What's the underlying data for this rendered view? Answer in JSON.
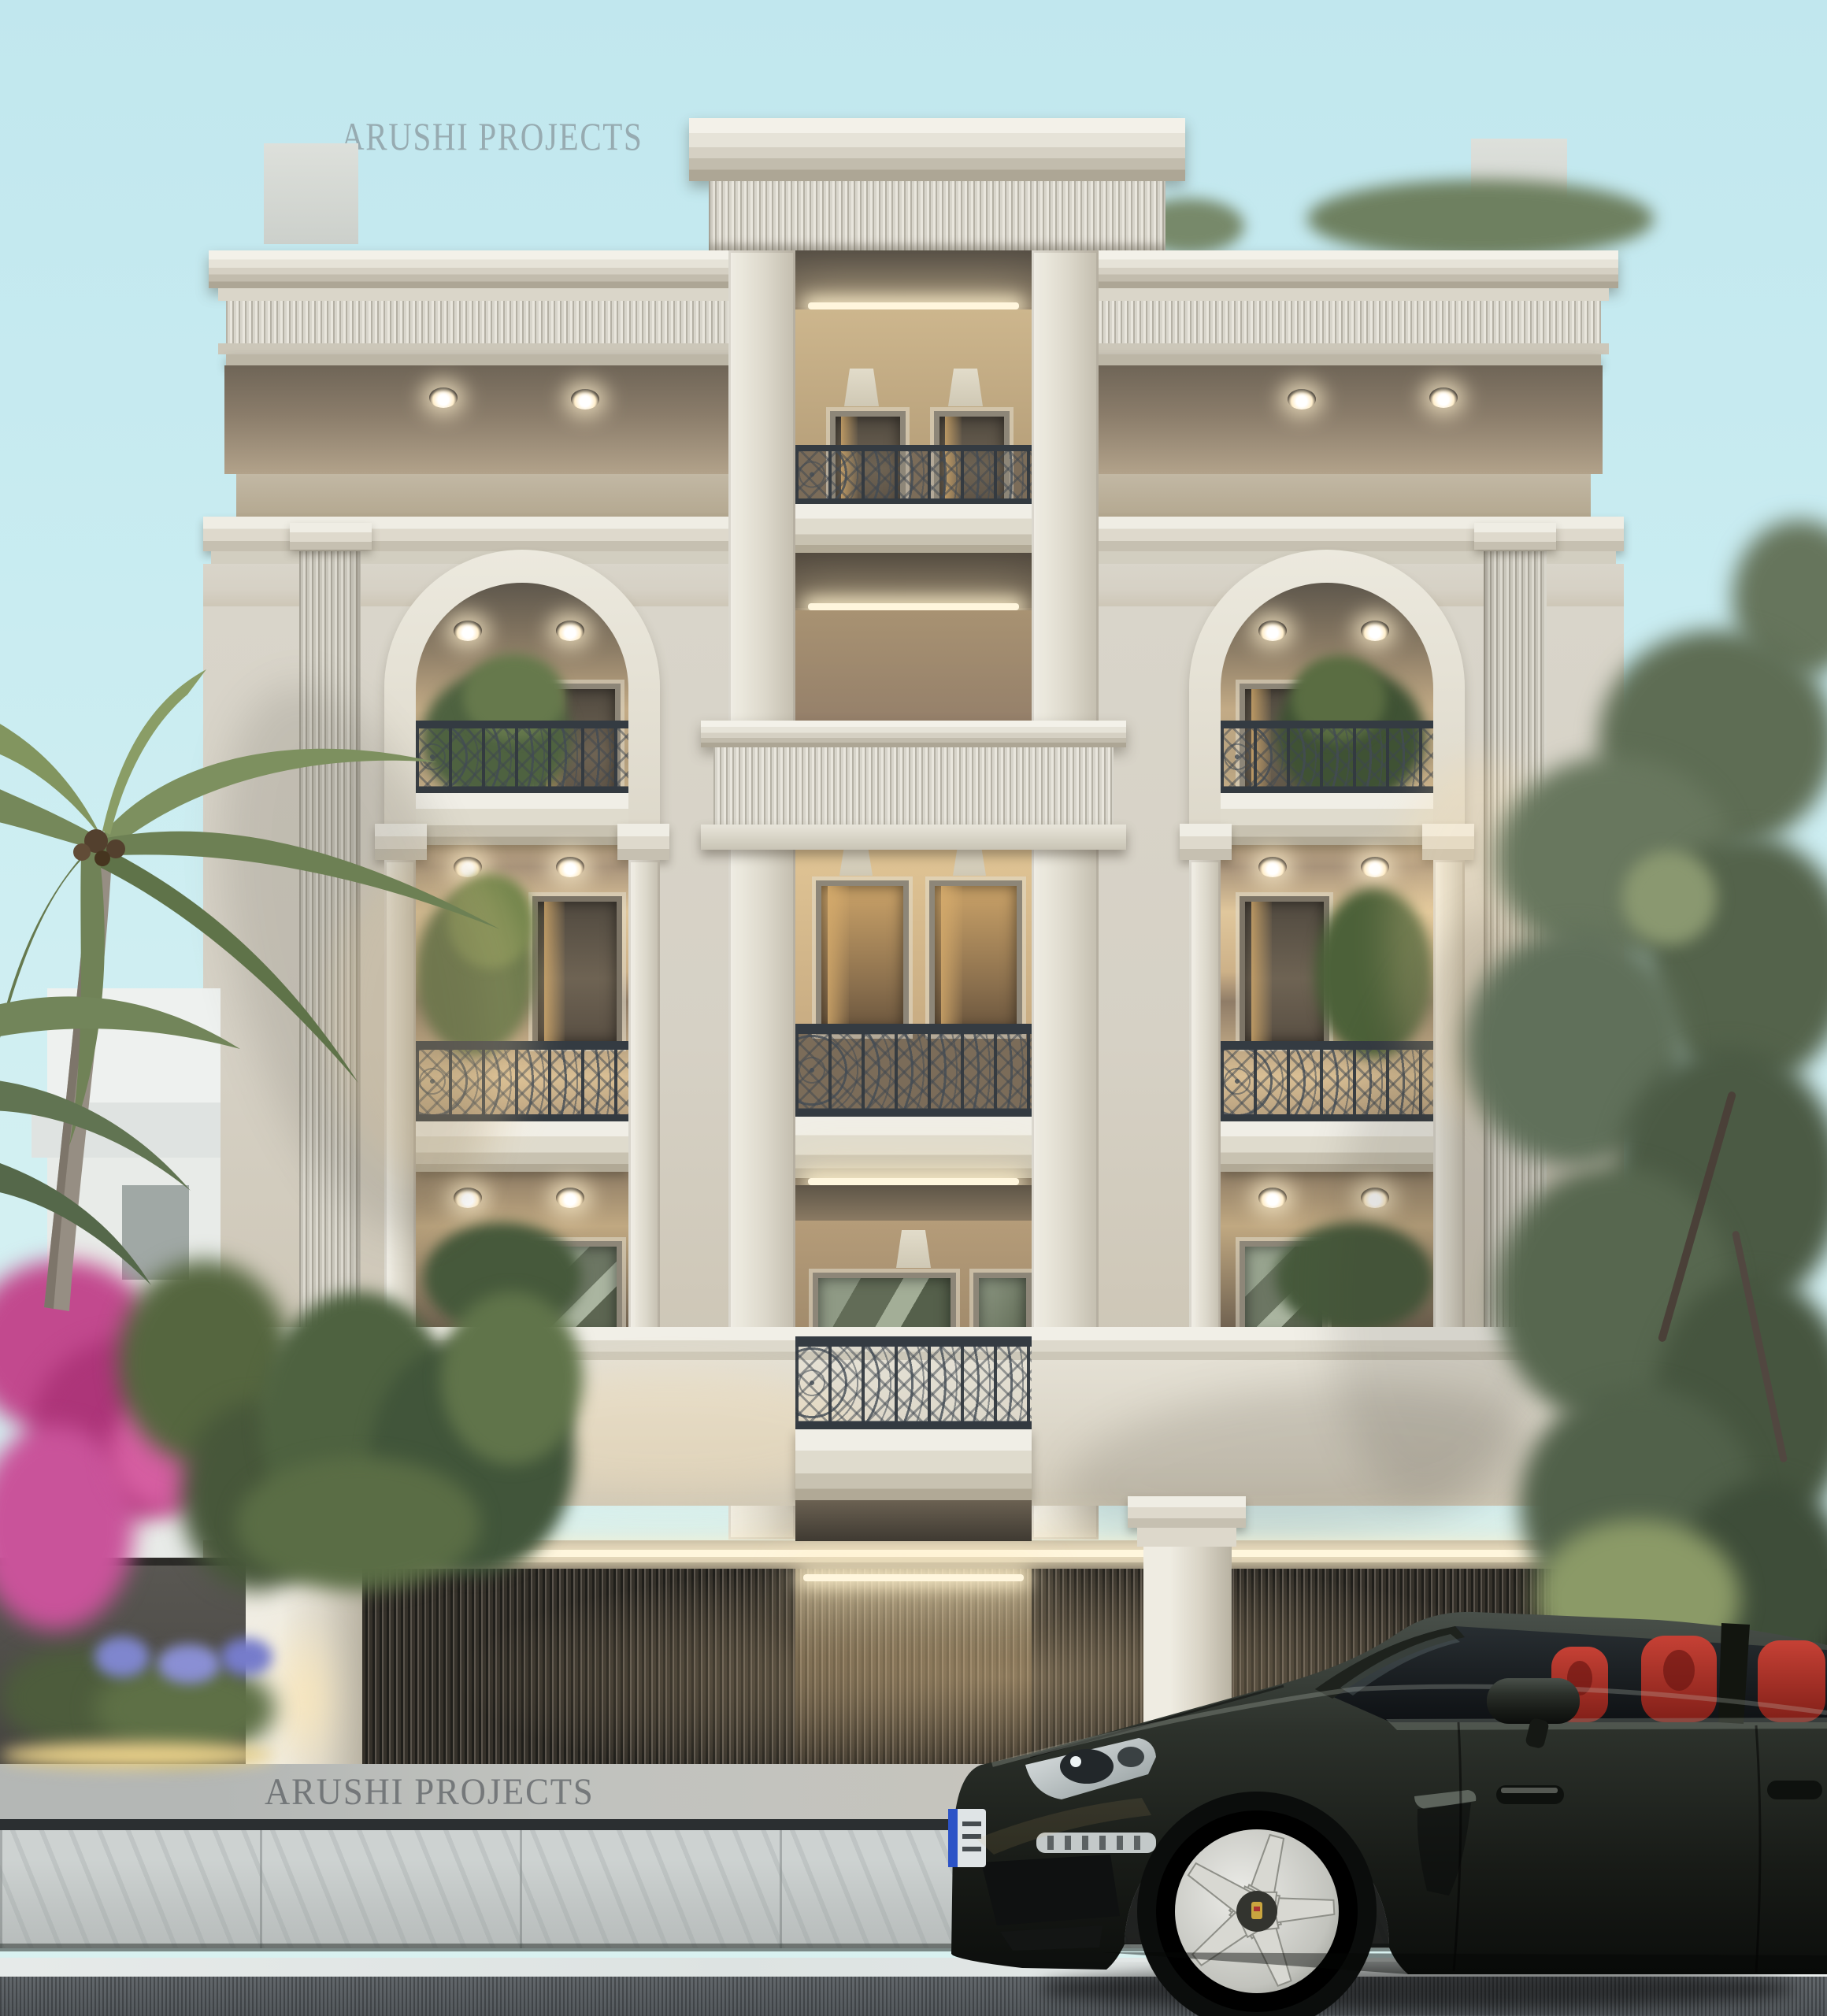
{
  "watermarks": {
    "top": "ARUSHI PROJECTS",
    "bottom": "ARUSHI PROJECTS"
  },
  "palette": {
    "sky": "#c6eaf0",
    "facade_cream": "#d9d5ca",
    "cornice_white": "#f0eee6",
    "soffit_warm": "#8a7c69",
    "interior_warm_light": "#e3c493",
    "led_strip": "#fff6dd",
    "iron_railing": "#343b42",
    "slat_fence": "#46423a",
    "stone_wall": "#4c4a47",
    "sidewalk": "#c6cbca",
    "asphalt": "#5b6064",
    "road_marking": "#e9edec",
    "car_body": "#232823",
    "car_seats": "#b43a2e",
    "car_wheel": "#d5d5d0",
    "tree_foliage": "#66755c",
    "palm_foliage": "#7d905f",
    "bougainvillea": "#c2498e",
    "agapanthus": "#8087cf"
  },
  "scene_objects": [
    "neoclassical residence facade",
    "central attic crown",
    "fluted friezes",
    "double-height arched balcony niches",
    "ornate wrought-iron railings",
    "recessed LED cove lights",
    "slatted entrance gate",
    "classical gate pillars",
    "stone boundary wall",
    "coconut palm",
    "bougainvillea",
    "street tree",
    "dark luxury sedan with red interior",
    "sidewalk and asphalt road"
  ]
}
